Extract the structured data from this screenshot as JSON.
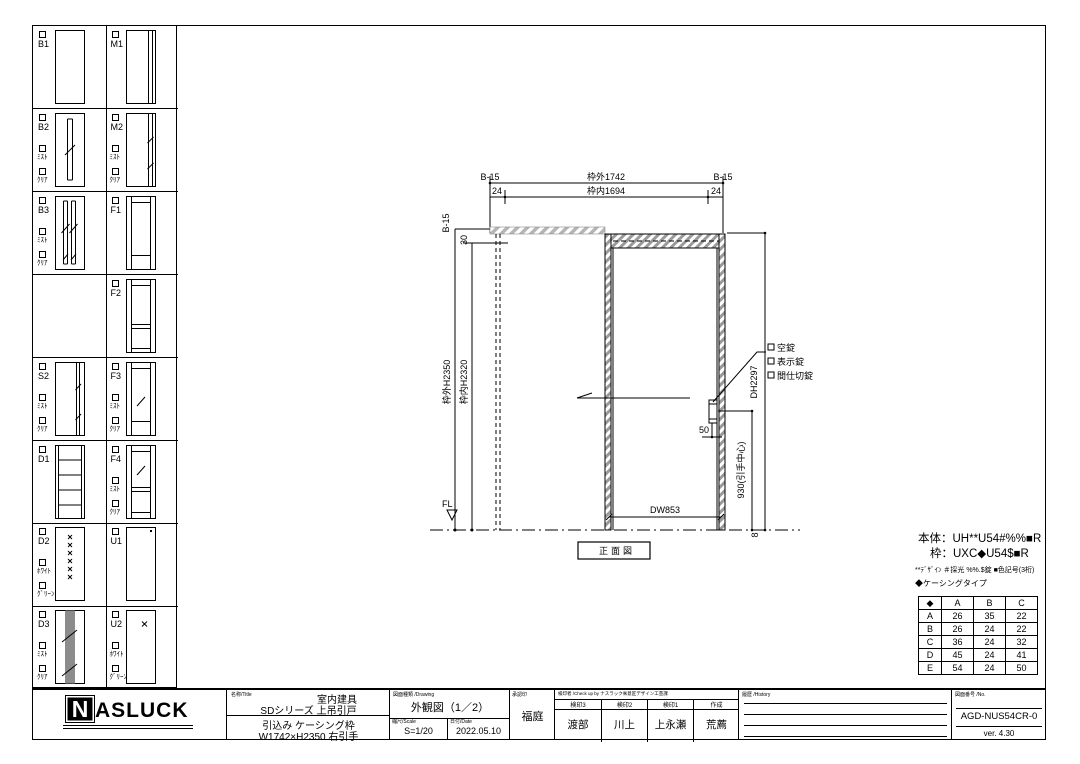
{
  "sidebar": {
    "cells": [
      {
        "id": "B1",
        "col": 0,
        "row": 0,
        "thumb": "plain",
        "subs": []
      },
      {
        "id": "M1",
        "col": 1,
        "row": 0,
        "thumb": "strip-right",
        "subs": []
      },
      {
        "id": "B2",
        "col": 0,
        "row": 1,
        "thumb": "slot-center",
        "subs": [
          "ﾐｽﾄ",
          "ｸﾘｱ"
        ]
      },
      {
        "id": "M2",
        "col": 1,
        "row": 1,
        "thumb": "slot-right",
        "subs": [
          "ﾐｽﾄ",
          "ｸﾘｱ"
        ]
      },
      {
        "id": "B3",
        "col": 0,
        "row": 2,
        "thumb": "slot-double",
        "subs": [
          "ﾐｽﾄ",
          "ｸﾘｱ"
        ]
      },
      {
        "id": "F1",
        "col": 1,
        "row": 2,
        "thumb": "frame",
        "subs": []
      },
      {
        "id": "F2",
        "col": 1,
        "row": 3,
        "thumb": "frame-2rail",
        "subs": []
      },
      {
        "id": "S2",
        "col": 0,
        "row": 4,
        "thumb": "slot-right-full",
        "subs": [
          "ﾐｽﾄ",
          "ｸﾘｱ"
        ]
      },
      {
        "id": "F3",
        "col": 1,
        "row": 4,
        "thumb": "frame-glass",
        "subs": [
          "ﾐｽﾄ",
          "ｸﾘｱ"
        ]
      },
      {
        "id": "D1",
        "col": 0,
        "row": 5,
        "thumb": "rails-4",
        "subs": []
      },
      {
        "id": "F4",
        "col": 1,
        "row": 5,
        "thumb": "frame-glass-panel",
        "subs": [
          "ﾐｽﾄ",
          "ｸﾘｱ"
        ]
      },
      {
        "id": "D2",
        "col": 0,
        "row": 6,
        "thumb": "dots",
        "subs": [
          "ﾎﾜｲﾄ",
          "ｸﾞﾘｰﾝ"
        ]
      },
      {
        "id": "U1",
        "col": 1,
        "row": 6,
        "thumb": "plain-mark",
        "subs": []
      },
      {
        "id": "D3",
        "col": 0,
        "row": 7,
        "thumb": "stripe-gray",
        "subs": [
          "ﾐｽﾄ",
          "ｸﾘｱ"
        ]
      },
      {
        "id": "U2",
        "col": 1,
        "row": 7,
        "thumb": "mark",
        "subs": [
          "ﾎﾜｲﾄ",
          "ｸﾞﾘｰﾝ"
        ]
      }
    ]
  },
  "drawing": {
    "top_dims": {
      "b15_left": "B-15",
      "outer": "枠外1742",
      "b15_right": "B-15",
      "m24_left": "24",
      "inner": "枠内1694",
      "m24_right": "24"
    },
    "left_dims": {
      "b15": "B-15",
      "d30": "30",
      "outer_h": "枠外H2350",
      "inner_h": "枠内H2320"
    },
    "right_dims": {
      "dh": "DH2297",
      "pull_center": "930(引手中心)",
      "d8": "8",
      "d50": "50"
    },
    "locks": [
      "空錠",
      "表示錠",
      "間仕切錠"
    ],
    "door_width": "DW853",
    "floor_label": "FL",
    "caption": "正面図"
  },
  "notes": {
    "body": "本体：UH**U54#%%■R",
    "frame": "枠：UXC◆U54$■R",
    "legend": "**ﾃﾞｻﾞｲﾝ ＃採光 %%.$錠 ■色記号(3桁)",
    "casing": "◆ケーシングタイプ",
    "table": {
      "headers": [
        "◆",
        "A",
        "B",
        "C"
      ],
      "rows": [
        [
          "A",
          "26",
          "35",
          "22"
        ],
        [
          "B",
          "26",
          "24",
          "22"
        ],
        [
          "C",
          "36",
          "24",
          "32"
        ],
        [
          "D",
          "45",
          "24",
          "41"
        ],
        [
          "E",
          "54",
          "24",
          "50"
        ]
      ]
    }
  },
  "titleblock": {
    "logo": "NASLUCK",
    "name_header": "名称/Title",
    "name1": "室内建具",
    "name2": "SDシリーズ 上吊引戸",
    "name3": "引込み ケーシング枠",
    "name4": "W1742×H2350 右引手",
    "drawing_header": "図面種類 /Drawing",
    "drawing_title": "外観図（1／2）",
    "scale_header": "縮尺/Scale",
    "scale": "S=1/20",
    "date_header": "日付/Date",
    "date": "2022.05.10",
    "approval_header": "承認印",
    "approver": "福庭",
    "check_header": "検印者 /Check up by ナスラック㈱意匠デザイン工芸課",
    "check_cols": [
      {
        "label": "検印3",
        "name": "渡部"
      },
      {
        "label": "検印2",
        "name": "川上"
      },
      {
        "label": "検印1",
        "name": "上永瀬"
      },
      {
        "label": "作成",
        "name": "荒薦"
      }
    ],
    "history_header": "履歴 /History",
    "no_header": "図面番号 /No.",
    "drawing_no": "AGD-NUS54CR-0",
    "version": "ver. 4.30"
  }
}
